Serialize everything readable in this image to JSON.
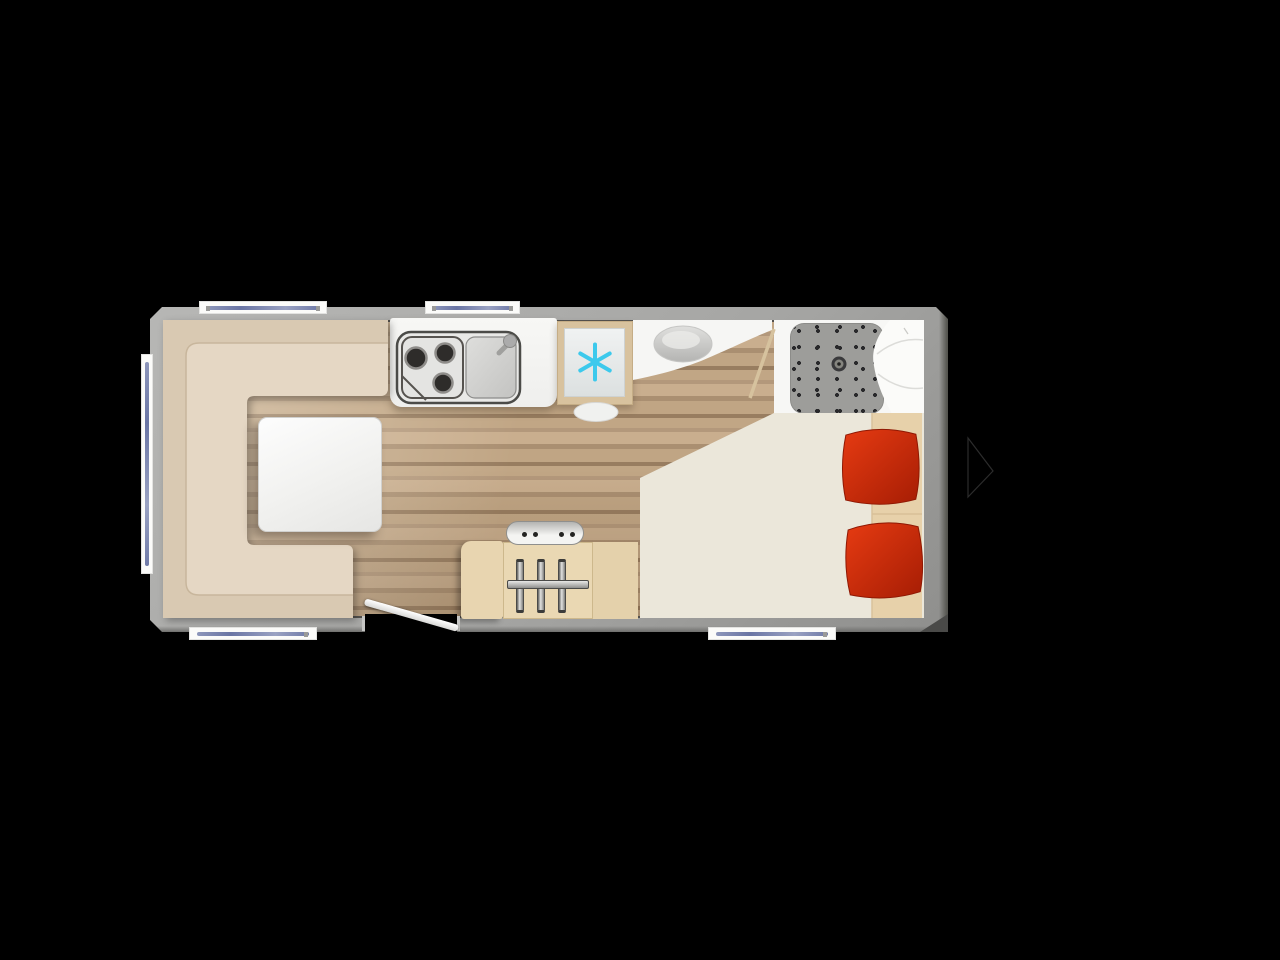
{
  "scene": {
    "type": "caravan-floorplan-top-view",
    "background": "#000000",
    "visible_text": ""
  },
  "colors": {
    "wall_gray": "#a6a6a4",
    "floor_wood_light": "#c9ae8e",
    "floor_wood_dark": "#987d60",
    "sofa_base": "#d9c9b2",
    "sofa_seat": "#e5d7c4",
    "table_white": "#f4f4f2",
    "counter_white": "#f3f3f1",
    "appliance_outline": "#4b4b48",
    "fridge_frame_tan": "#d8c29e",
    "snowflake_cyan": "#3cc9ec",
    "bathroom_white": "#f7f7f5",
    "basin_gray": "#c5c5c3",
    "shower_tray_gray": "#9d9d9a",
    "bed_cream": "#ebe7da",
    "bed_strip_tan": "#e7d1aa",
    "pillow_red_light": "#e63b12",
    "pillow_red_dark": "#a61d04",
    "cabinet_tan": "#ead8b3",
    "window_line_blue": "#6a75a4",
    "door_white": "#f2f2f0",
    "arrow_outline": "#2c2c2c"
  },
  "icons": {
    "fridge_symbol": "snowflake-icon",
    "next_control": "next-arrow-icon"
  }
}
